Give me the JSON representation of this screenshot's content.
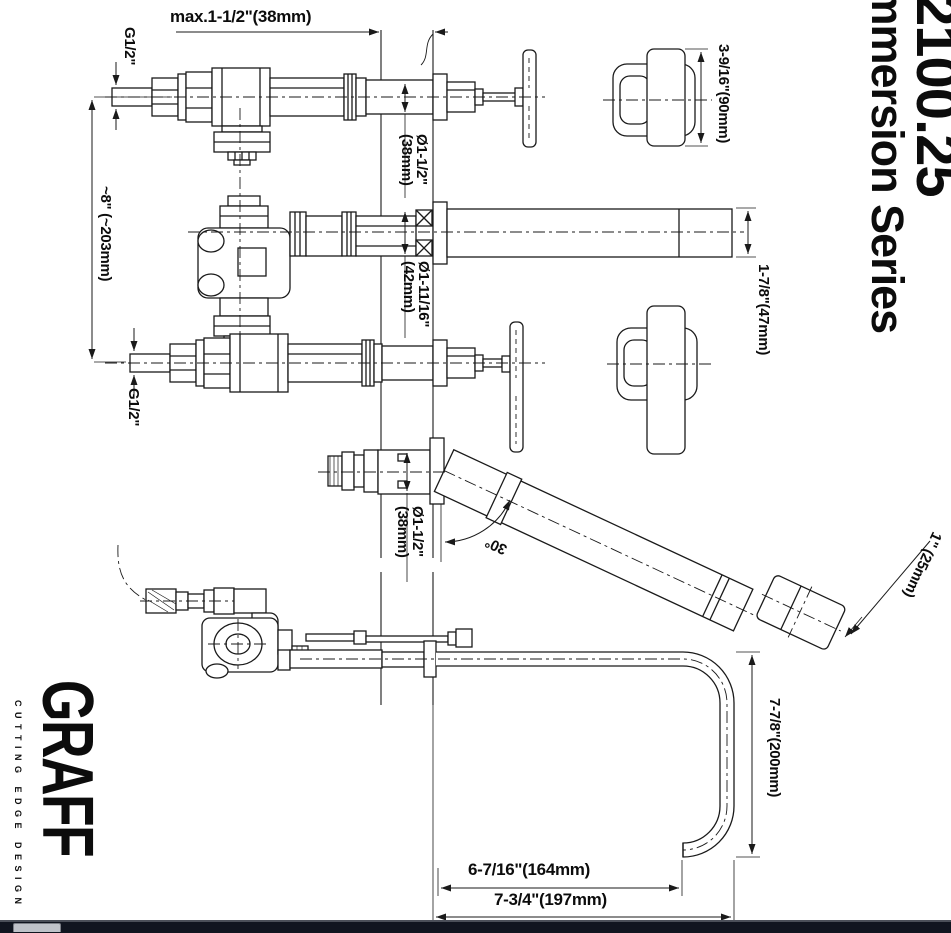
{
  "titles": {
    "model_number": "2100.25",
    "series": "Immersion Series"
  },
  "brand": {
    "name": "GRAFF",
    "tagline": "CUTTING EDGE DESIGN"
  },
  "dimensions": {
    "wall_thickness_max": "max.1-1/2\"(38mm)",
    "inlet_top": "G1/2\"",
    "inlet_bottom": "G1/2\"",
    "valve_center_distance": "~8\" (~203mm)",
    "valve_escutcheon_dia": "Ø1-1/2\"\n(38mm)",
    "spout_escutcheon_dia": "Ø1-11/16\"\n(42mm)",
    "handshower_escutcheon_dia": "Ø1-1/2\"\n(38mm)",
    "handle_detail_size": "3-9/16\"(90mm)",
    "spout_tube_dia": "1-7/8\"(47mm)",
    "handshower_angle": "30°",
    "handshower_tip_length": "1\" (25mm)",
    "hook_spout_drop": "7-7/8\"(200mm)",
    "hook_spout_reach_inner": "6-7/16\"(164mm)",
    "hook_spout_reach_outer": "7-3/4\"(197mm)"
  },
  "colors": {
    "line": "#1a1a1a",
    "footer": "#10151f"
  }
}
